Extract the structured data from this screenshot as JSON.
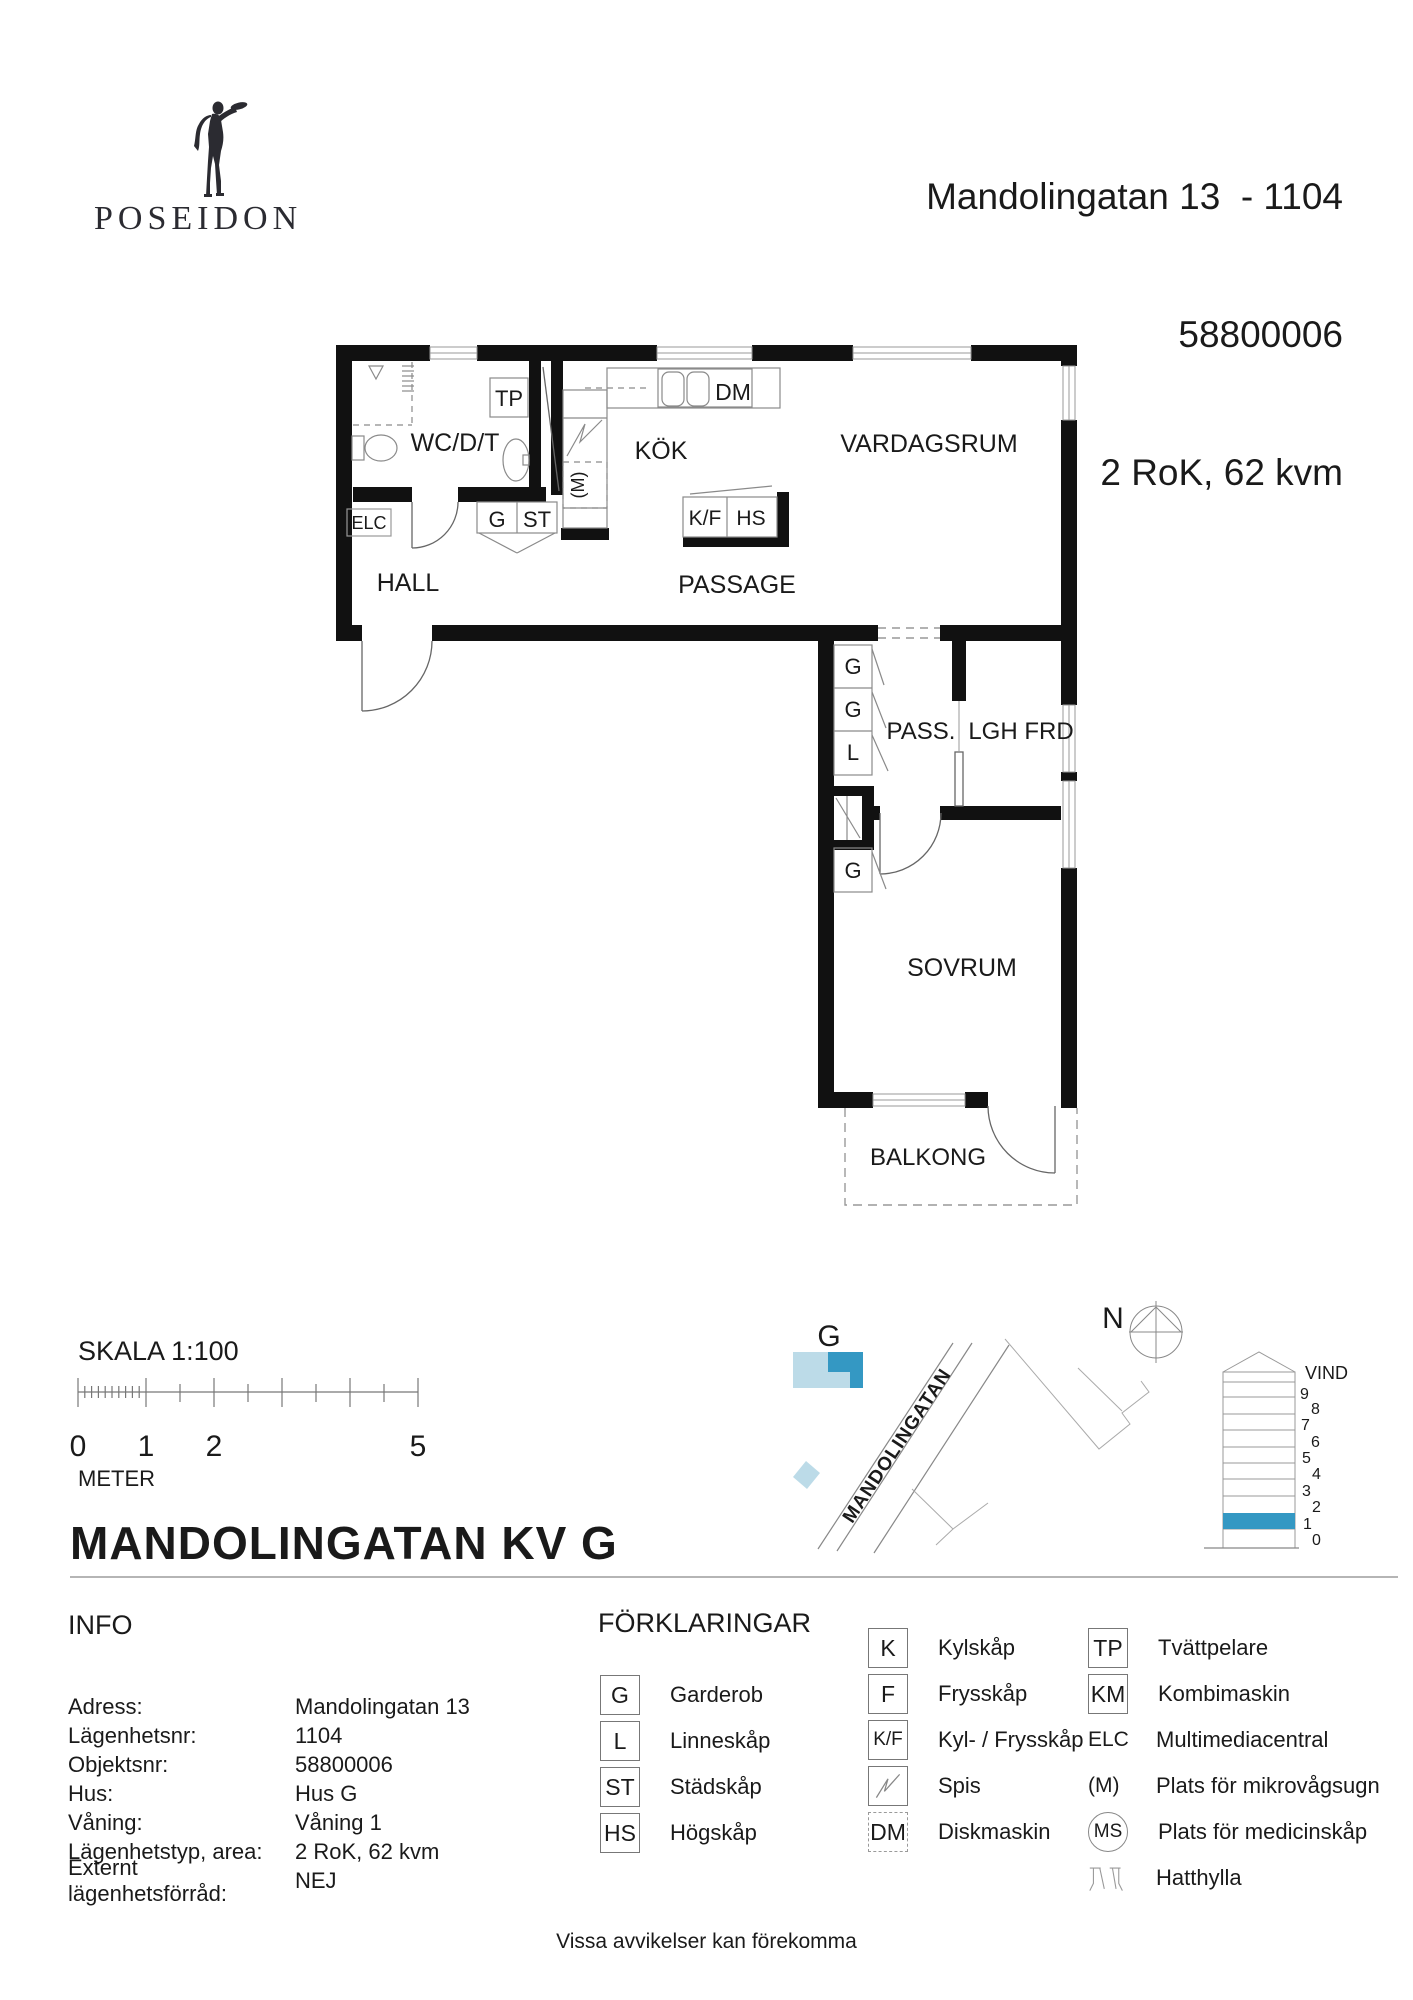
{
  "brand": {
    "name": "POSEIDON"
  },
  "header": {
    "address": "Mandolingatan 13  - 1104",
    "object_number": "58800006",
    "type_area": "2 RoK, 62 kvm"
  },
  "plan": {
    "rooms": {
      "wc": "WC/D/T",
      "hall": "HALL",
      "kok": "KÖK",
      "vardagsrum": "VARDAGSRUM",
      "passage": "PASSAGE",
      "pass": "PASS.",
      "lgh_frd": "LGH FRD",
      "sovrum": "SOVRUM",
      "balkong": "BALKONG"
    },
    "fixtures": {
      "tp": "TP",
      "dm": "DM",
      "elc": "ELC",
      "g_hall": "G",
      "st": "ST",
      "kf": "K/F",
      "hs": "HS",
      "m": "(M)",
      "g1": "G",
      "g2": "G",
      "l": "L",
      "g3": "G"
    }
  },
  "scale": {
    "title": "SKALA 1:100",
    "unit": "METER",
    "ticks": [
      "0",
      "1",
      "2",
      "5"
    ]
  },
  "site": {
    "building": "G",
    "street": "MANDOLINGATAN",
    "north": "N"
  },
  "elevation": {
    "attic": "VIND",
    "floors": [
      "9",
      "8",
      "7",
      "6",
      "5",
      "4",
      "3",
      "2",
      "1",
      "0"
    ],
    "highlighted_floor": "1"
  },
  "title": "MANDOLINGATAN KV G",
  "info": {
    "heading": "INFO",
    "rows": [
      {
        "label": "Adress:",
        "value": "Mandolingatan 13"
      },
      {
        "label": "Lägenhetsnr:",
        "value": "1104"
      },
      {
        "label": "Objektsnr:",
        "value": "58800006"
      },
      {
        "label": "Hus:",
        "value": "Hus G"
      },
      {
        "label": "Våning:",
        "value": "Våning 1"
      },
      {
        "label": "Lägenhetstyp, area:",
        "value": "2 RoK, 62 kvm"
      },
      {
        "label": "Externt lägenhetsförråd:",
        "value": "NEJ"
      }
    ]
  },
  "legend": {
    "heading": "FÖRKLARINGAR",
    "col1": [
      {
        "symbol": "G",
        "label": "Garderob"
      },
      {
        "symbol": "L",
        "label": "Linneskåp"
      },
      {
        "symbol": "ST",
        "label": "Städskåp"
      },
      {
        "symbol": "HS",
        "label": "Högskåp"
      }
    ],
    "col2": [
      {
        "symbol": "K",
        "label": "Kylskåp"
      },
      {
        "symbol": "F",
        "label": "Frysskåp"
      },
      {
        "symbol": "K/F",
        "label": "Kyl- / Frysskåp"
      },
      {
        "symbol": "",
        "label": "Spis"
      },
      {
        "symbol": "DM",
        "label": "Diskmaskin"
      }
    ],
    "col3": [
      {
        "symbol": "TP",
        "label": "Tvättpelare"
      },
      {
        "symbol": "KM",
        "label": "Kombimaskin"
      },
      {
        "symbol": "ELC",
        "label": "Multimediacentral"
      },
      {
        "symbol": "(M)",
        "label": "Plats för mikrovågsugn"
      },
      {
        "symbol": "MS",
        "label": "Plats för medicinskåp"
      },
      {
        "symbol": "",
        "label": "Hatthylla"
      }
    ]
  },
  "footer": "Vissa avvikelser kan förekomma",
  "colors": {
    "accent_blue": "#3498c3",
    "light_blue": "#bcdbe8",
    "wall_black": "#111111"
  }
}
